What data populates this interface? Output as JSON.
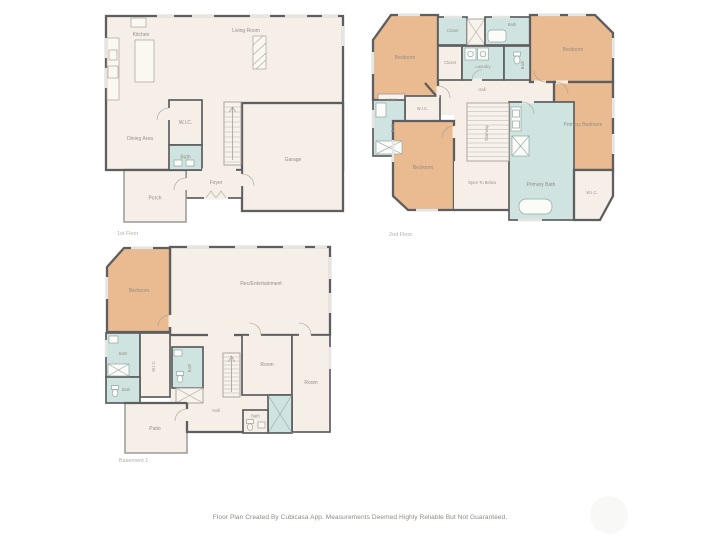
{
  "page": {
    "background": "#ffffff",
    "footer": "Floor Plan Created By Cubicasa App. Measurements Deemed Highly Reliable But Not Guaranteed."
  },
  "palette": {
    "wall": "#5e5e60",
    "floor_fill": "#f6efe8",
    "bedroom_fill": "#eaba90",
    "bath_fill": "#cfe4e1",
    "porch_wall": "#9a9a98",
    "label_color": "#958e85"
  },
  "floors": [
    {
      "name": "1st Floor",
      "rooms": [
        {
          "label": "Kitchen"
        },
        {
          "label": "Living Room"
        },
        {
          "label": "Dining Area"
        },
        {
          "label": "W.I.C."
        },
        {
          "label": "Bath"
        },
        {
          "label": "Foyer"
        },
        {
          "label": "Porch"
        },
        {
          "label": "Garage"
        }
      ]
    },
    {
      "name": "2nd Floor",
      "rooms": [
        {
          "label": "Bedroom"
        },
        {
          "label": "Closet"
        },
        {
          "label": "Bath"
        },
        {
          "label": "Bedroom"
        },
        {
          "label": "Closet"
        },
        {
          "label": "Laundry"
        },
        {
          "label": "Bath"
        },
        {
          "label": "Hall"
        },
        {
          "label": "Linen"
        },
        {
          "label": "W.I.C."
        },
        {
          "label": "Bath"
        },
        {
          "label": "Bedroom"
        },
        {
          "label": "Stairway"
        },
        {
          "label": "Open To Below"
        },
        {
          "label": "Primary Bedroom"
        },
        {
          "label": "Primary Bath"
        },
        {
          "label": "W.I.C."
        }
      ]
    },
    {
      "name": "Basement 1",
      "rooms": [
        {
          "label": "Bedroom"
        },
        {
          "label": "Rec/Entertainment"
        },
        {
          "label": "Bath"
        },
        {
          "label": "W.I.C."
        },
        {
          "label": "Bath"
        },
        {
          "label": "Bath"
        },
        {
          "label": "Hall"
        },
        {
          "label": "Room"
        },
        {
          "label": "Room"
        },
        {
          "label": "Bath"
        },
        {
          "label": "Patio"
        }
      ]
    }
  ]
}
